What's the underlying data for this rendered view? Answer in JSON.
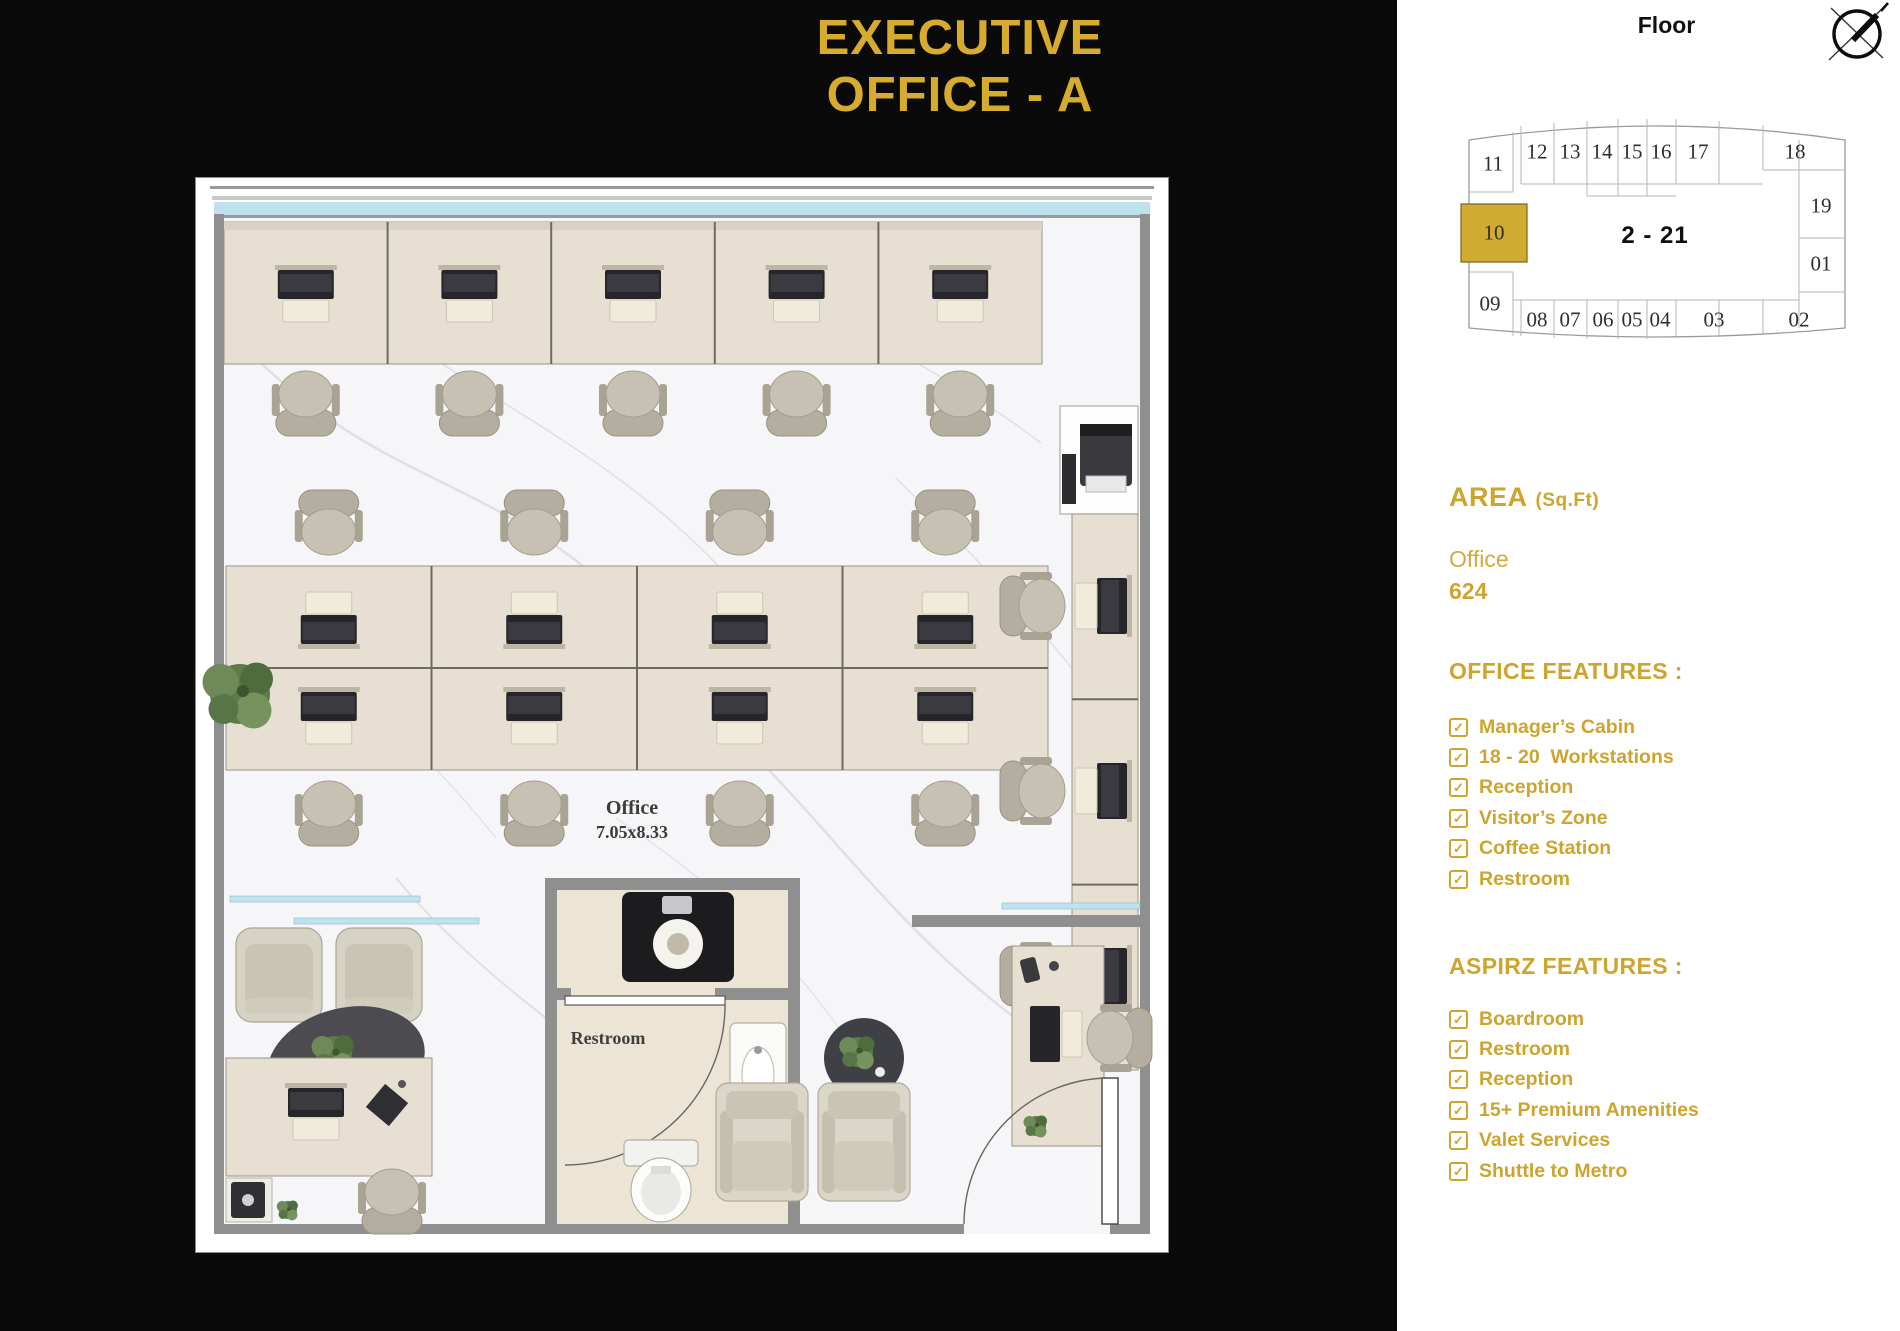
{
  "title": {
    "line1": "EXECUTIVE",
    "line2": "OFFICE - A"
  },
  "colors": {
    "accent_gold": "#CDA42E",
    "title_gold": "#D7AB2D",
    "background_black": "#0A0A0A",
    "panel_white": "#FFFFFF",
    "highlighted_unit_fill": "#D2AB33",
    "window_glass_cyan": "#BFE3EE",
    "wall_gray": "#8F8F8F",
    "desk_wood": "#E7E0D2"
  },
  "icons": {
    "checkbox_checked": "✓",
    "compass": "compass-north-icon"
  },
  "floor_plan": {
    "office_label": "Office",
    "office_dimensions": "7.05x8.33",
    "restroom_label": "Restroom"
  },
  "side_panel": {
    "floor_heading": "Floor",
    "floor_diagram": {
      "center_label": "2 - 21",
      "highlighted_unit": "10",
      "units_top": [
        "11",
        "12",
        "13",
        "14",
        "15",
        "16",
        "17",
        "18"
      ],
      "units_right": [
        "19",
        "01"
      ],
      "units_bottom": [
        "08",
        "07",
        "06",
        "05",
        "04",
        "03",
        "02"
      ],
      "units_left": [
        "09"
      ]
    },
    "area": {
      "heading": "AREA",
      "unit_suffix": "(Sq.Ft)",
      "label": "Office",
      "value": "624"
    },
    "office_features": {
      "heading": "OFFICE FEATURES :",
      "items": [
        "Manager’s Cabin",
        "18 - 20  Workstations",
        "Reception",
        "Visitor’s Zone",
        "Coffee Station",
        "Restroom"
      ]
    },
    "aspirz_features": {
      "heading": "ASPIRZ FEATURES :",
      "items": [
        "Boardroom",
        "Restroom",
        "Reception",
        "15+ Premium Amenities",
        "Valet Services",
        "Shuttle to Metro"
      ]
    }
  }
}
